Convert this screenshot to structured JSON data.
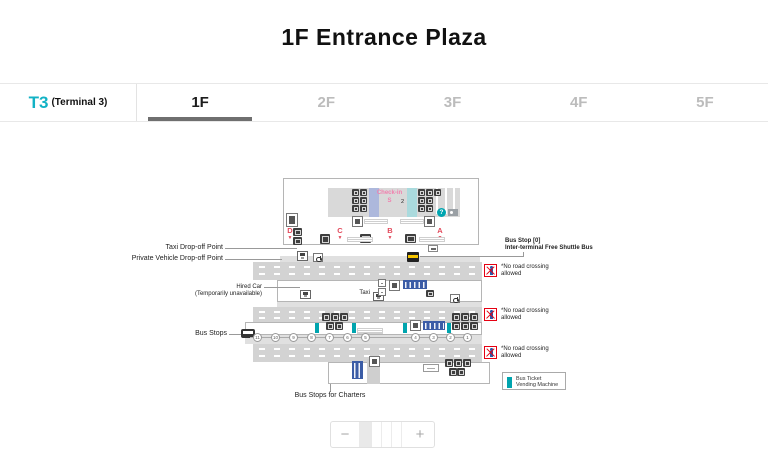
{
  "title": "1F Entrance Plaza",
  "terminal": {
    "code": "T3",
    "note": "(Terminal 3)"
  },
  "tabs": [
    {
      "label": "1F"
    },
    {
      "label": "2F"
    },
    {
      "label": "3F"
    },
    {
      "label": "4F"
    },
    {
      "label": "5F"
    }
  ],
  "active_tab": "1F",
  "map": {
    "checkin": {
      "line1": "Check-in",
      "line2": "S"
    },
    "building_numbers": [
      "2",
      "2"
    ],
    "info_mark": "?",
    "doors": [
      "D",
      "C",
      "B",
      "A"
    ],
    "door_arrow": "▼",
    "labels": {
      "taxi_dropoff": "Taxi Drop-off Point",
      "private_vehicle": "Private Vehicle Drop-off Point",
      "hired_car_line1": "Hired Car",
      "hired_car_line2": "(Temporarily unavailable)",
      "taxi": "Taxi",
      "bus_stops": "Bus Stops",
      "bus_charters": "Bus Stops for Charters",
      "bus_stop0_line1": "Bus Stop [0]",
      "bus_stop0_line2": "Inter-terminal Free Shuttle Bus",
      "no_crossing": "*No road crossing allowed"
    },
    "bus_stop_numbers": [
      "11",
      "10",
      "9",
      "8",
      "7",
      "6",
      "5",
      "4",
      "3",
      "2",
      "1"
    ],
    "legend": {
      "line1": "Bus Ticket",
      "line2": "Vending Machine"
    }
  },
  "zoom_control": {
    "minus": "−",
    "plus": "+"
  },
  "colors": {
    "terminal_teal": "#12b2c5",
    "door_red": "#e2485a",
    "checkin_pink": "#f17fae",
    "toilet_blue": "#3b5ca6",
    "vending_teal": "#00a4ae",
    "no_cross_red": "#e60012",
    "road_gray": "#d3d3d3"
  }
}
